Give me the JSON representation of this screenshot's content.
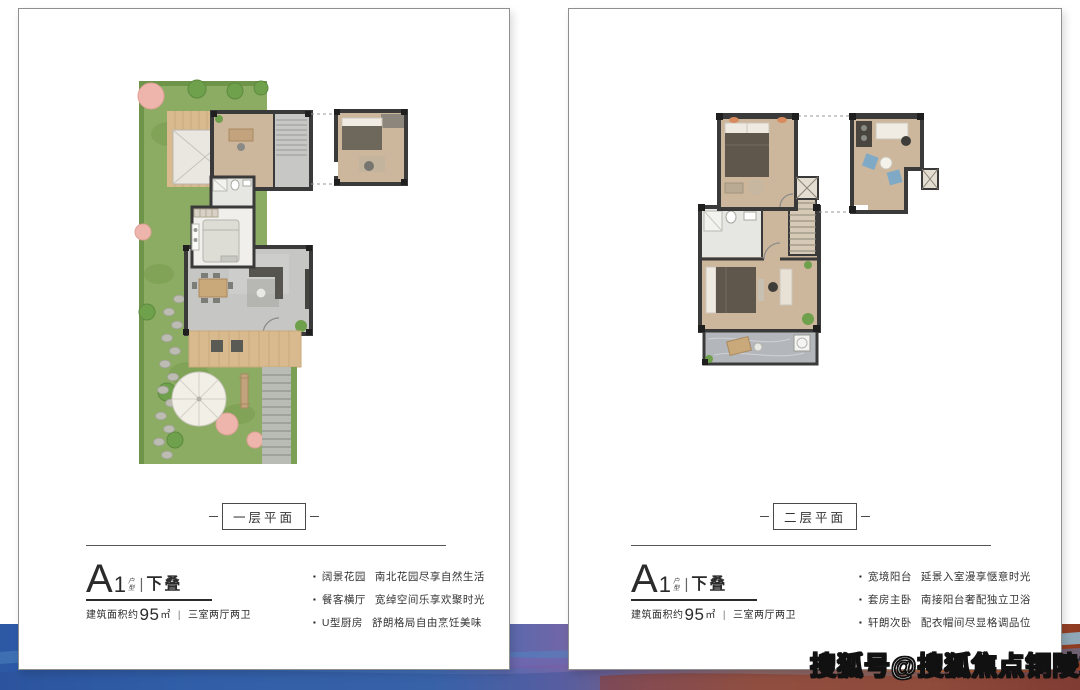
{
  "watermark": {
    "text": "搜狐号@搜狐焦点铜陵站",
    "fill": "#ffffff",
    "outline": "#111111"
  },
  "icons": {
    "bullet": "▪"
  },
  "colors": {
    "card_border": "#8f8f8f",
    "text": "#2e2e2e",
    "paint_blue": "#2c58a4",
    "paint_purple": "#6f66a8",
    "paint_orange": "#c1754f",
    "paint_red": "#8f3b22",
    "garden_green": "#8cab63",
    "wood_floor": "#cdb79c",
    "wall": "#3a3a3a"
  },
  "cards": {
    "left": {
      "badge": "一层平面",
      "unit": {
        "letter": "A",
        "number": "1",
        "stack_top": "户",
        "stack_bottom": "型",
        "divider": "|",
        "name": "下叠"
      },
      "area": {
        "prefix": "建筑面积约",
        "value": "95",
        "unit": "㎡",
        "separator": "|",
        "rooms": "三室两厅两卫"
      },
      "features": [
        {
          "title": "阔景花园",
          "desc": "南北花园尽享自然生活"
        },
        {
          "title": "餐客横厅",
          "desc": "宽绰空间乐享欢聚时光"
        },
        {
          "title": "U型厨房",
          "desc": "舒朗格局自由烹饪美味"
        }
      ]
    },
    "right": {
      "badge": "二层平面",
      "unit": {
        "letter": "A",
        "number": "1",
        "stack_top": "户",
        "stack_bottom": "型",
        "divider": "|",
        "name": "下叠"
      },
      "area": {
        "prefix": "建筑面积约",
        "value": "95",
        "unit": "㎡",
        "separator": "|",
        "rooms": "三室两厅两卫"
      },
      "features": [
        {
          "title": "宽境阳台",
          "desc": "延景入室漫享惬意时光"
        },
        {
          "title": "套房主卧",
          "desc": "南接阳台奢配独立卫浴"
        },
        {
          "title": "轩朗次卧",
          "desc": "配衣帽间尽显格调品位"
        }
      ]
    }
  }
}
